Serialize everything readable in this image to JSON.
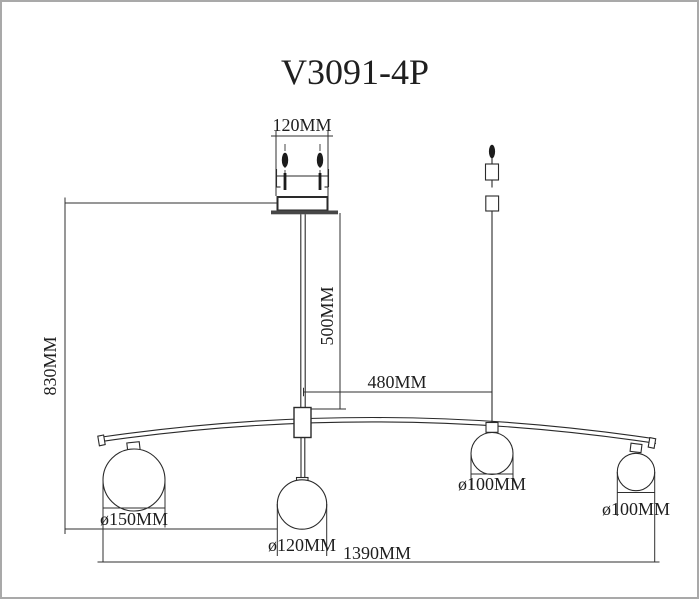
{
  "title": "V3091-4P",
  "colors": {
    "background": "#ffffff",
    "line": "#2a2a2a",
    "border": "#a9a9a9",
    "screw_fill": "#1c1c1c",
    "plate_fill": "#474747"
  },
  "dimensions": {
    "canopy_width": "120MM",
    "rod_length": "500MM",
    "overall_height": "830MM",
    "center_to_cable": "480MM",
    "overall_width": "1390MM"
  },
  "globes": [
    {
      "diameter_label": "ø150MM"
    },
    {
      "diameter_label": "ø120MM"
    },
    {
      "diameter_label": "ø100MM"
    },
    {
      "diameter_label": "ø100MM"
    }
  ]
}
